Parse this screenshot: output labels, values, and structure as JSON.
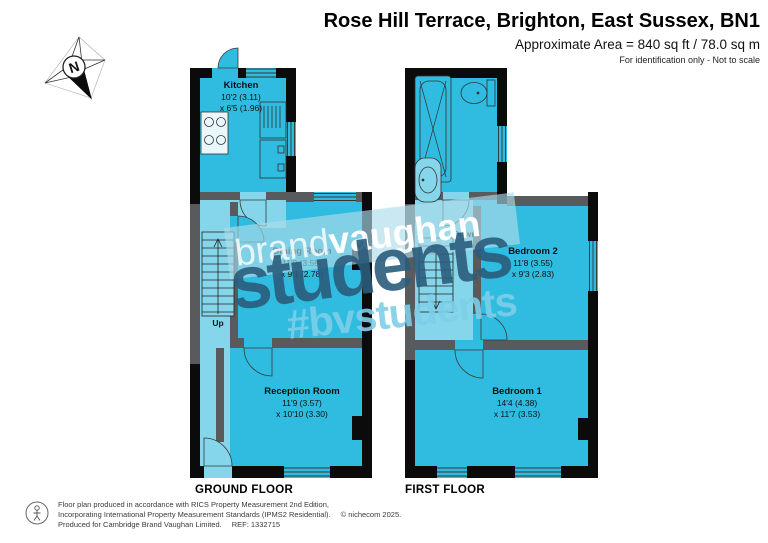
{
  "header": {
    "title": "Rose Hill Terrace, Brighton, East Sussex, BN1",
    "area_line": "Approximate Area = 840 sq ft / 78.0 sq m",
    "disclaimer": "For identification only - Not to scale"
  },
  "compass": {
    "north_label": "N"
  },
  "watermark": {
    "brand_prefix": "brand",
    "brand_suffix": "vaughan",
    "big_text": "students",
    "hashtag": "#bvstudents"
  },
  "floors": [
    {
      "label": "GROUND FLOOR",
      "stairs_label": "Up",
      "rooms": [
        {
          "name": "Kitchen",
          "dim1": "10'2 (3.11)",
          "dim2": "x 6'5 (1.96)"
        },
        {
          "name": "Dining Room",
          "dim1": "11'9 (3.59)",
          "dim2": "x 9'1 (2.78)"
        },
        {
          "name": "Reception Room",
          "dim1": "11'9 (3.57)",
          "dim2": "x 10'10 (3.30)"
        }
      ]
    },
    {
      "label": "FIRST FLOOR",
      "stairs_label": "Down",
      "rooms": [
        {
          "name": "Bedroom 2",
          "dim1": "11'8 (3.55)",
          "dim2": "x 9'3 (2.83)"
        },
        {
          "name": "Bedroom 1",
          "dim1": "14'4 (4.38)",
          "dim2": "x 11'7 (3.53)"
        }
      ]
    }
  ],
  "footer": {
    "line1": "Floor plan produced in accordance with RICS Property Measurement 2nd Edition,",
    "line2": "Incorporating International Property Measurement Standards (IPMS2 Residential).",
    "copyright": "© nichecom 2025.",
    "line3": "Produced for Cambridge Brand Vaughan Limited.",
    "ref": "REF: 1332715"
  },
  "colors": {
    "room-fill": "#30bbe0",
    "hall-fill": "#85d6ea",
    "wall-black": "#0b0b0b",
    "wall-gray": "#585a5c",
    "banner-blue": "rgba(173,219,233,0.65)",
    "watermark-dark": "rgba(42,92,124,0.9)",
    "watermark-light": "rgba(125,206,232,0.9)"
  }
}
